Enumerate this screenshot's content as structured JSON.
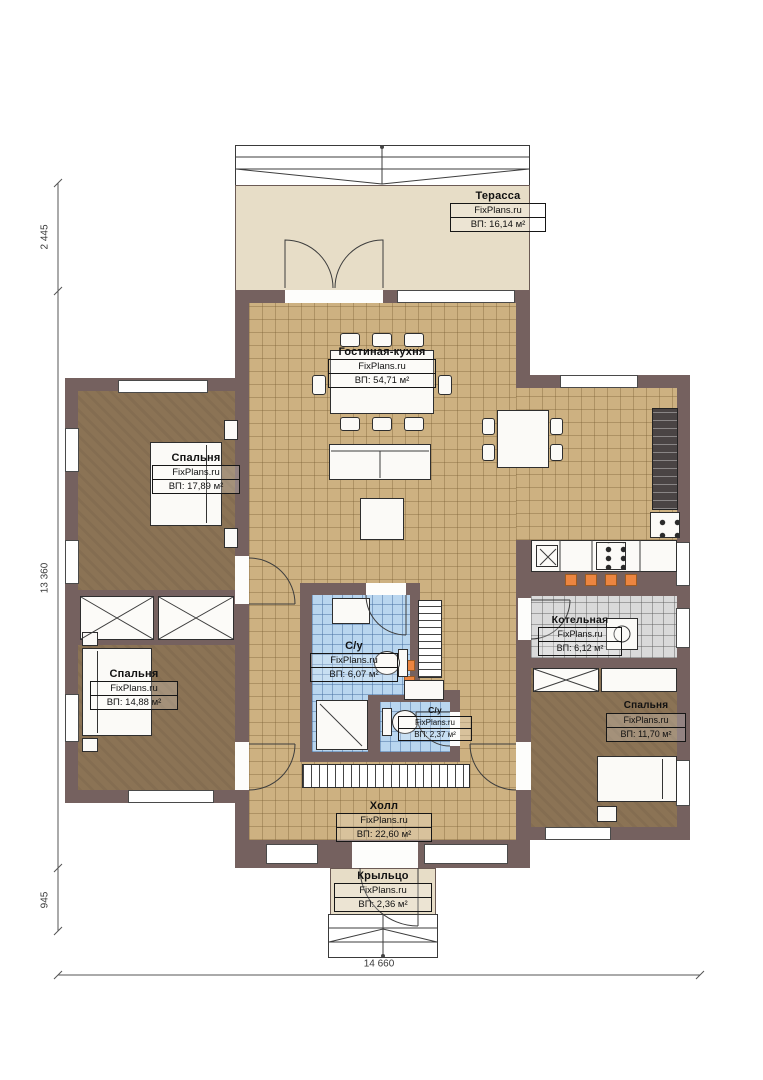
{
  "plan": {
    "brand": "FixPlans.ru",
    "rooms": {
      "terrace": {
        "name": "Терасса",
        "brand": "FixPlans.ru",
        "area": "ВП: 16,14 м²"
      },
      "living_kitchen": {
        "name": "Гостиная-кухня",
        "brand": "FixPlans.ru",
        "area": "ВП: 54,71 м²"
      },
      "bedroom1": {
        "name": "Спальня",
        "brand": "FixPlans.ru",
        "area": "ВП: 17,89 м²"
      },
      "bedroom2": {
        "name": "Спальня",
        "brand": "FixPlans.ru",
        "area": "ВП: 14,88 м²"
      },
      "bathroom1": {
        "name": "С/у",
        "brand": "FixPlans.ru",
        "area": "ВП: 6,07 м²"
      },
      "bathroom2": {
        "name": "С/у",
        "brand": "FixPlans.ru",
        "area": "ВП: 2,37 м²"
      },
      "boiler": {
        "name": "Котельная",
        "brand": "FixPlans.ru",
        "area": "ВП: 6,12 м²"
      },
      "bedroom3": {
        "name": "Спальня",
        "brand": "FixPlans.ru",
        "area": "ВП: 11,70 м²"
      },
      "hall": {
        "name": "Холл",
        "brand": "FixPlans.ru",
        "area": "ВП: 22,60 м²"
      },
      "porch": {
        "name": "Крыльцо",
        "brand": "FixPlans.ru",
        "area": "ВП: 2,36 м²"
      }
    },
    "dimensions": {
      "terrace_depth": "2 445",
      "house_height": "13 360",
      "porch_depth": "945",
      "house_width": "14 660"
    },
    "colors": {
      "wall": "#75615f",
      "tile_beige": "#cdb181",
      "floor_brown": "#8b7355",
      "tile_blue": "#b9d6ef",
      "tile_grey": "#dadada",
      "terrace_cream": "#e7ddc7",
      "accent_orange": "#ec8540"
    }
  }
}
